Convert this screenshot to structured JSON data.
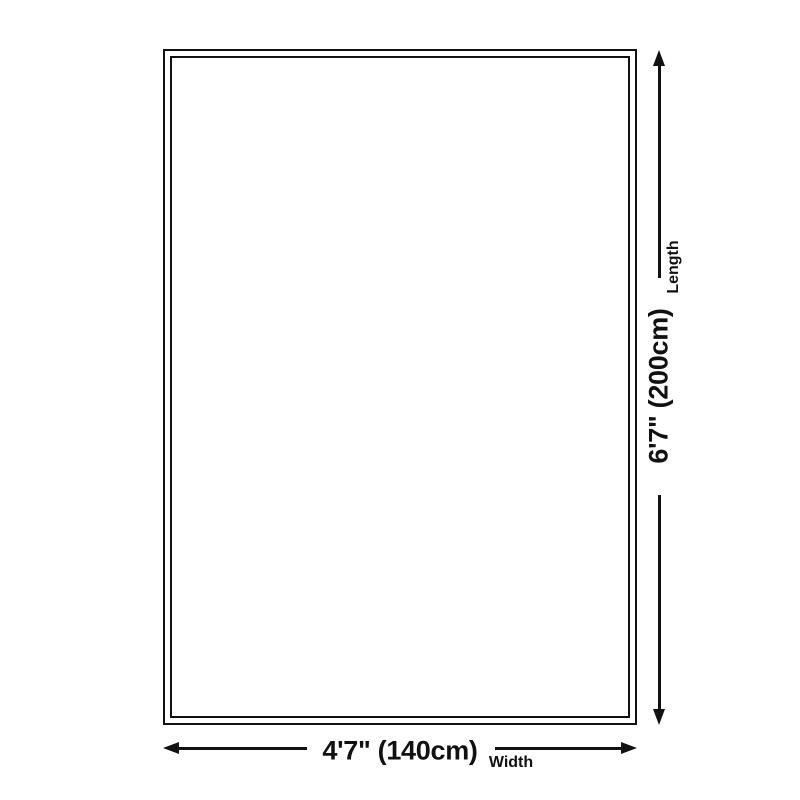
{
  "diagram": {
    "width": {
      "value": "4'7\" (140cm)",
      "label": "Width"
    },
    "length": {
      "value": "6'7\" (200cm)",
      "label": "Length"
    },
    "colors": {
      "ink": "#111111",
      "background": "#ffffff"
    }
  }
}
